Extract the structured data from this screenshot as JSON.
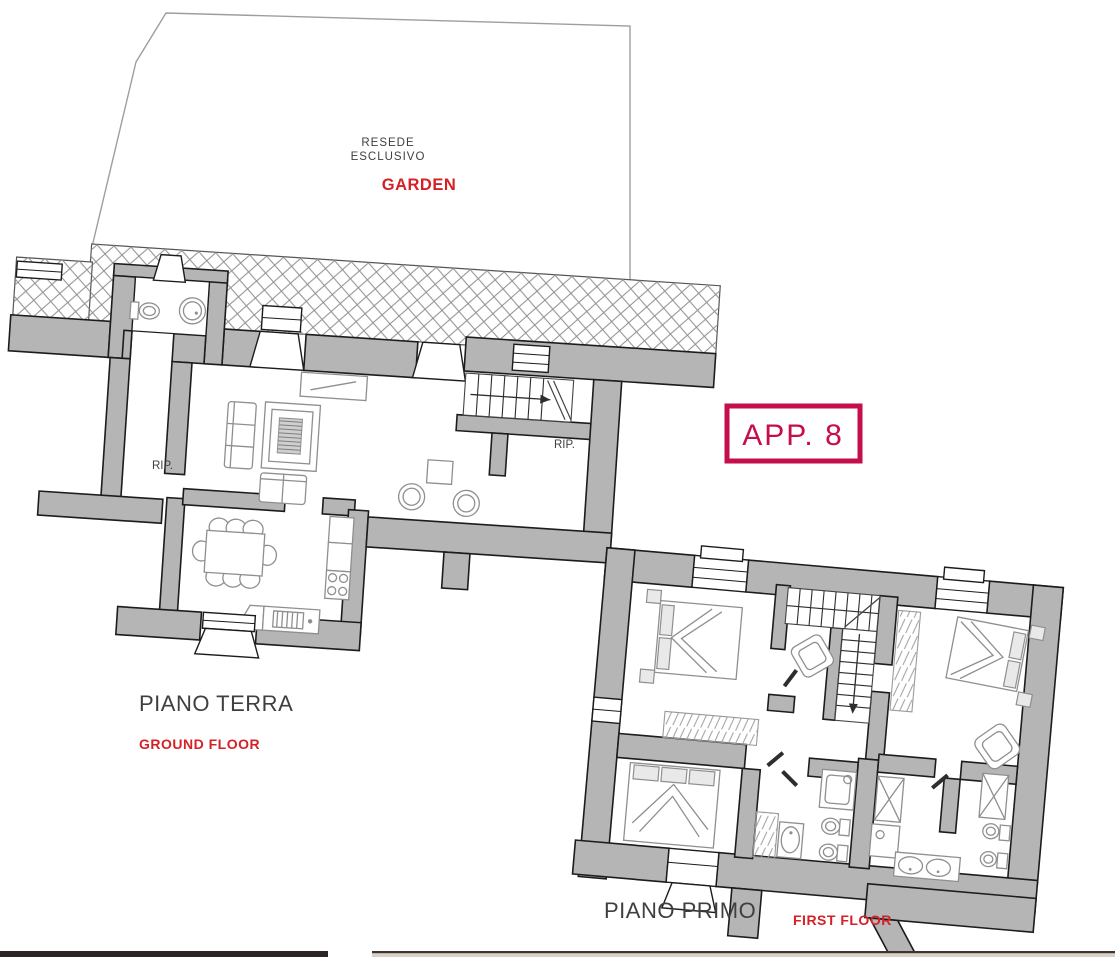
{
  "labels": {
    "resede_line1": "RESEDE",
    "resede_line2": "ESCLUSIVO",
    "garden": "GARDEN",
    "apartment": "APP. 8",
    "rip": "RIP.",
    "ground_floor_it": "PIANO TERRA",
    "ground_floor_en": "GROUND FLOOR",
    "first_floor_it": "PIANO PRIMO",
    "first_floor_en": "FIRST FLOOR"
  },
  "colors": {
    "accent_red": "#d42127",
    "badge_crimson": "#c60d4d",
    "text_dark": "#3f3f3f",
    "wall_gray": "#b5b5b5",
    "wall_outline": "#1c1c1c",
    "furniture_gray": "#8f8f8f",
    "hatch_gray": "#8f8f8f",
    "bottom_bar_dark": "#2b2624",
    "bottom_strip_beige": "#d9d0c8"
  }
}
